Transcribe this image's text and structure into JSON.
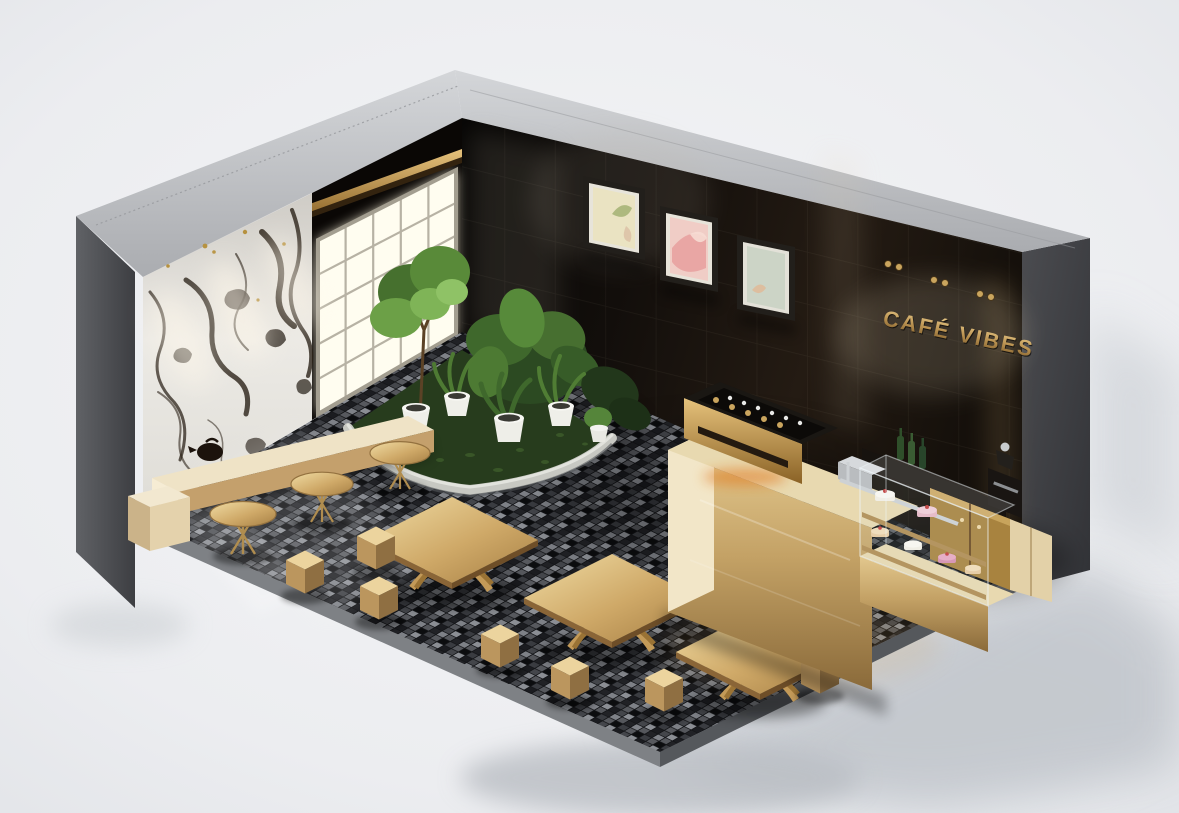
{
  "scene": {
    "type": "3d-isometric-render",
    "subject": "luxury cafe interior diorama with open-cut walls",
    "sign": {
      "text": "CAFÉ VIBES"
    },
    "palette": {
      "background": "#edeff1",
      "exterior_gray": "#55575b",
      "rim_gray": "#c7c9cc",
      "dark_tile_wall": "#14100d",
      "marble_white": "#e9e7e2",
      "marble_vein": "#2b2218",
      "window_glow": "#fffdf0",
      "gold": "#c9a76a",
      "gold_deep": "#8a6a3a",
      "floor_tile_dark": "#1b1c20",
      "floor_tile_mid": "#55575c",
      "floor_tile_light": "#8b8e94",
      "plant_green": "#5c8a3d",
      "grass_green": "#273c1d",
      "curb_gray": "#c7c8c2",
      "artwork_colors": [
        "#eae3c2",
        "#eec0bc",
        "#ccd4c6"
      ],
      "cake_pink": "#d98fb0",
      "cherry_red": "#c23b3b",
      "glow_orange": "#e0771e"
    },
    "objects": [
      "marble accent wall with downlight pools",
      "grid window with daylight glow",
      "gold light bar above window",
      "black glossy tile wall",
      "three framed artworks",
      "gold cafe sign lettering",
      "gold track spotlights",
      "curved planter bed with potted plants",
      "gold espresso machine",
      "gold service counter",
      "glass pastry display case with cakes",
      "back bar with green bottles and coffee grinder",
      "gold wood cabinets",
      "cream wall bench with kettle",
      "round gold side tables",
      "square gold tables with sculptural bases",
      "gold cube stools",
      "black mosaic tile floor with reflections"
    ]
  }
}
